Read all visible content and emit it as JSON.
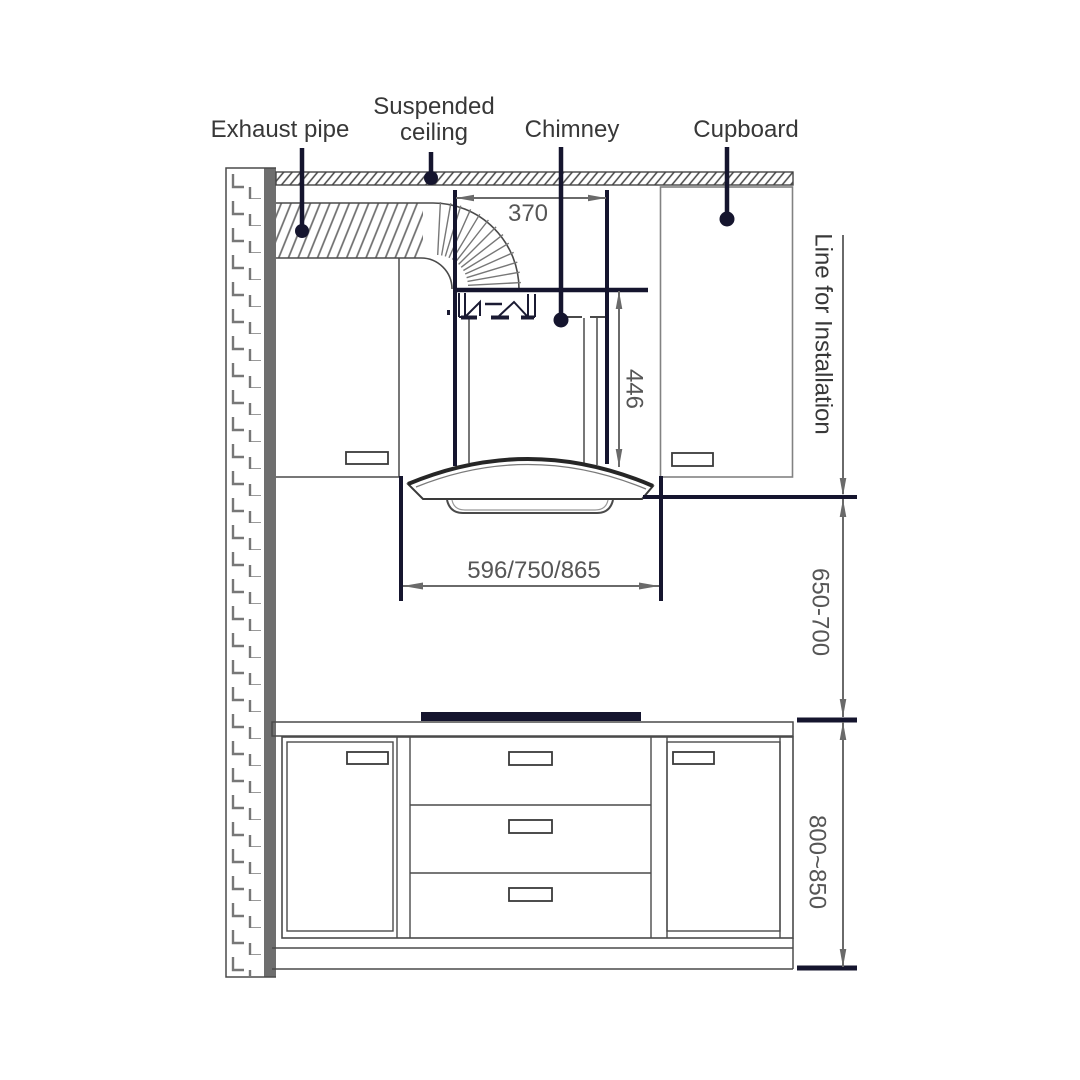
{
  "labels": {
    "exhaust_pipe": "Exhaust pipe",
    "suspended_ceiling_line1": "Suspended",
    "suspended_ceiling_line2": "ceiling",
    "chimney": "Chimney",
    "cupboard": "Cupboard",
    "line_for_installation": "Line for Installation"
  },
  "dimensions": {
    "duct_top_width": "370",
    "chimney_duct_height": "446",
    "hood_width_options": "596/750/865",
    "hood_to_counter_gap": "650-700",
    "counter_height": "800~850"
  },
  "colors": {
    "accent": "#15152e",
    "outline": "#4a4a4a",
    "outline_light": "#828282",
    "hatch": "#777777",
    "wall_fill": "#6e6e6e",
    "dim_line": "#6a6a6a",
    "dim_text": "#565656",
    "text": "#383838",
    "background": "#ffffff"
  }
}
